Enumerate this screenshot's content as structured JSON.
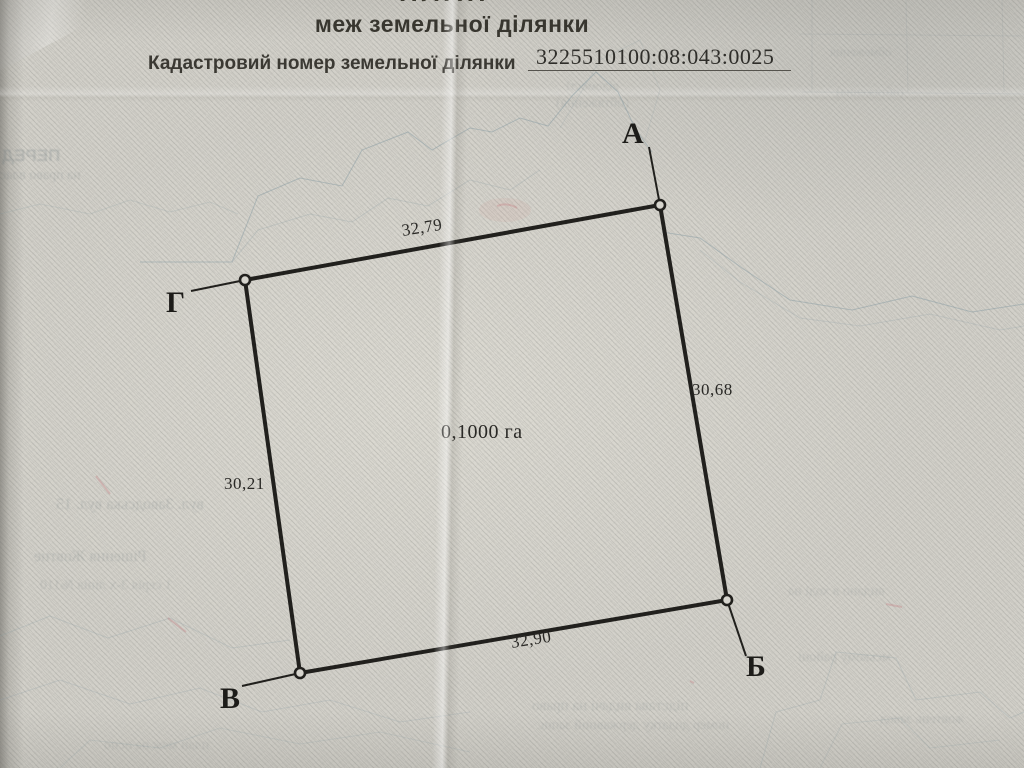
{
  "header": {
    "title_partial": "ПЛАН",
    "subtitle": "меж земельної ділянки",
    "cadastral_label": "Кадастровий номер земельної ділянки",
    "cadastral_number": "3225510100:08:043:0025"
  },
  "plan": {
    "area": "0,1000 га",
    "vertices": [
      {
        "label": "А"
      },
      {
        "label": "Б"
      },
      {
        "label": "В"
      },
      {
        "label": "Г"
      }
    ],
    "side_lengths": {
      "top": "32,79",
      "right": "30,68",
      "bottom": "32,90",
      "left": "30,21"
    }
  },
  "bleed": [
    {
      "text": "ПЕРЕД"
    },
    {
      "text": "на право влас"
    },
    {
      "text": "відомості"
    },
    {
      "text": "(обтяження)"
    },
    {
      "text": "обмеження"
    },
    {
      "text": "(обтяження)"
    },
    {
      "text": "вул. Заводська вул. 15"
    },
    {
      "text": "Рішення Жовтне"
    },
    {
      "text": "1 серія 3-х лінія №110"
    },
    {
      "text": "видано в ході на"
    },
    {
      "text": "мському районі"
    },
    {
      "text": "підстава видачі на право"
    },
    {
      "text": "номер додатку державний запис"
    },
    {
      "text": "жовтень завод"
    },
    {
      "text": "план меж на осно"
    }
  ],
  "colors": {
    "paper": "#d2d0c9",
    "ink": "#21201d",
    "contour_bleed": "#8fa0a6",
    "accent_red": "#c4737c"
  }
}
